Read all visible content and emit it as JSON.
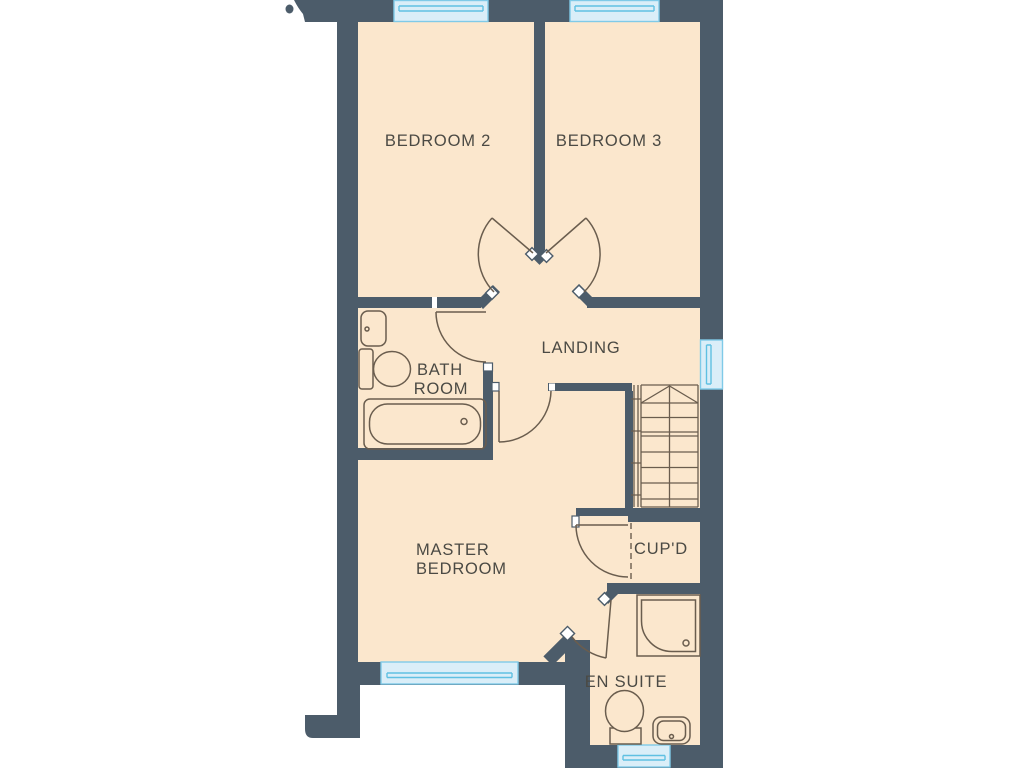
{
  "rooms": {
    "bedroom2": {
      "label": "BEDROOM 2"
    },
    "bedroom3": {
      "label": "BEDROOM 3"
    },
    "landing": {
      "label": "LANDING"
    },
    "bathroom": {
      "line1": "BATH",
      "line2": "ROOM"
    },
    "master": {
      "line1": "MASTER",
      "line2": "BEDROOM"
    },
    "cupboard": {
      "label": "CUP'D"
    },
    "ensuite": {
      "label": "EN SUITE"
    }
  },
  "icons": [
    "bathtub-icon",
    "toilet-icon",
    "sink-icon",
    "shower-icon",
    "stairs-icon",
    "window-icon",
    "door-swing-icon"
  ],
  "colors": {
    "wall": "#4c5c6a",
    "floor": "#fbe7cd",
    "window_fill": "#daeef8",
    "window_line": "#5fc0e2",
    "fixture_line": "#6a5d4e",
    "label_text": "#4b4a44",
    "background": "#ffffff"
  }
}
